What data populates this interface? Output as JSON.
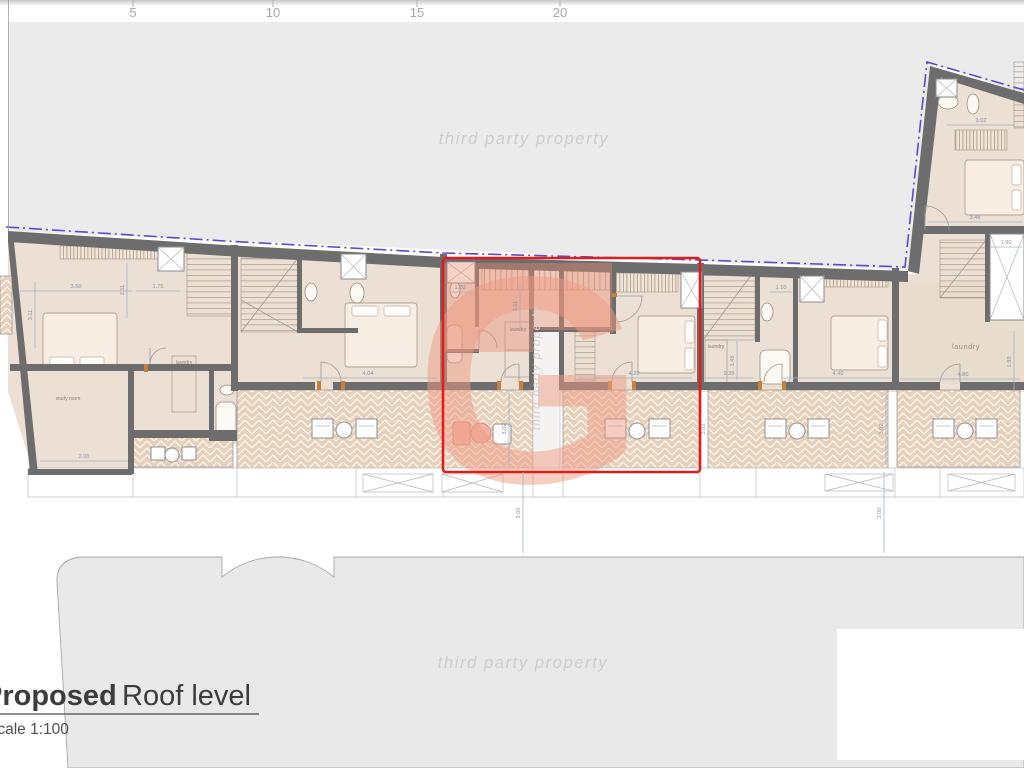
{
  "ruler": {
    "marks": [
      "5",
      "10",
      "15",
      "20"
    ]
  },
  "watermark": {
    "text": "third party property",
    "logo_letter": "G"
  },
  "title_block": {
    "title_emphasis": "Proposed",
    "title_rest": "Roof level",
    "scale_label": "Scale 1:100"
  },
  "room_labels": {
    "study_room": "study room",
    "laundry": "laundry"
  },
  "dimensions": {
    "d1": "3.60",
    "d2": "1.75",
    "d3": "1.20",
    "d4": "4.04",
    "d5": "4.28",
    "d6": "4.40",
    "d7": "2.35",
    "d8": "4.80",
    "d9": "3.48",
    "d10": "3.02",
    "d11": "1.90",
    "d12": "1.10",
    "d13": "3.02",
    "d14": "3.02",
    "d15": "3.02",
    "d16": "3.00",
    "d17": "3.00",
    "d18": "1.11",
    "d19": "2.00",
    "d20": "1.45",
    "d21": "1.93",
    "d22": "2.11",
    "d23": "3.11"
  },
  "colors": {
    "highlight_red": "#e11c1c",
    "boundary_purple": "#5a48cf",
    "wall_gray": "#6d6d6d",
    "room_beige": "#ece0d4",
    "terrace_tan": "#e7d1ba",
    "salmon_overlay": "#ec8a70",
    "watermark_gray": "#cdcdcd",
    "third_party_gray": "#ebebeb"
  }
}
